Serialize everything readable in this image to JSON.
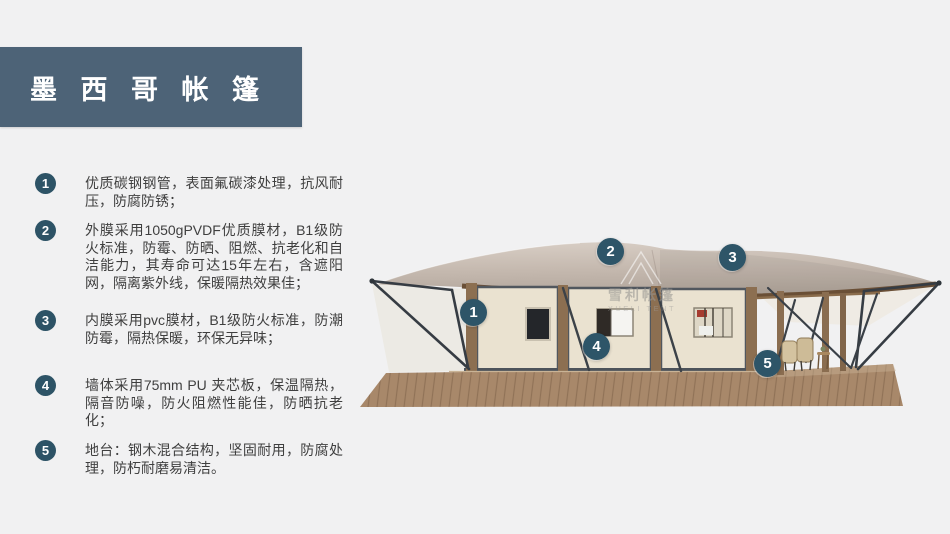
{
  "colors": {
    "background": "#f1f1f2",
    "title_bg": "#4d6377",
    "accent_circle": "#2e5568",
    "body_text": "#3f3f3f",
    "roof": "#c3b6ac",
    "wall": "#eae2d0",
    "wood_post": "#8c6f51",
    "deck": "#a8886a"
  },
  "title": {
    "text": "墨 西 哥 帐 篷"
  },
  "features": [
    {
      "num": "1",
      "text": "优质碳钢钢管，表面氟碳漆处理，抗风耐压，防腐防锈；"
    },
    {
      "num": "2",
      "text": "外膜采用1050gPVDF优质膜材，B1级防火标准，防霉、防晒、阻燃、抗老化和自洁能力，其寿命可达15年左右，含遮阳网，隔离紫外线，保暖隔热效果佳；"
    },
    {
      "num": "3",
      "text": "内膜采用pvc膜材，B1级防火标准，防潮防霉，隔热保暖，环保无异味；"
    },
    {
      "num": "4",
      "text": "墙体采用75mm PU 夹芯板，保温隔热，隔音防噪，防火阻燃性能佳，防晒抗老化；"
    },
    {
      "num": "5",
      "text": "地台：钢木混合结构，坚固耐用，防腐处理，防朽耐磨易清洁。"
    }
  ],
  "illustration": {
    "callouts": [
      {
        "num": "1"
      },
      {
        "num": "2"
      },
      {
        "num": "3"
      },
      {
        "num": "4"
      },
      {
        "num": "5"
      }
    ],
    "watermark": {
      "cn": "雪利帐篷",
      "en": "XUELI TENT"
    }
  }
}
